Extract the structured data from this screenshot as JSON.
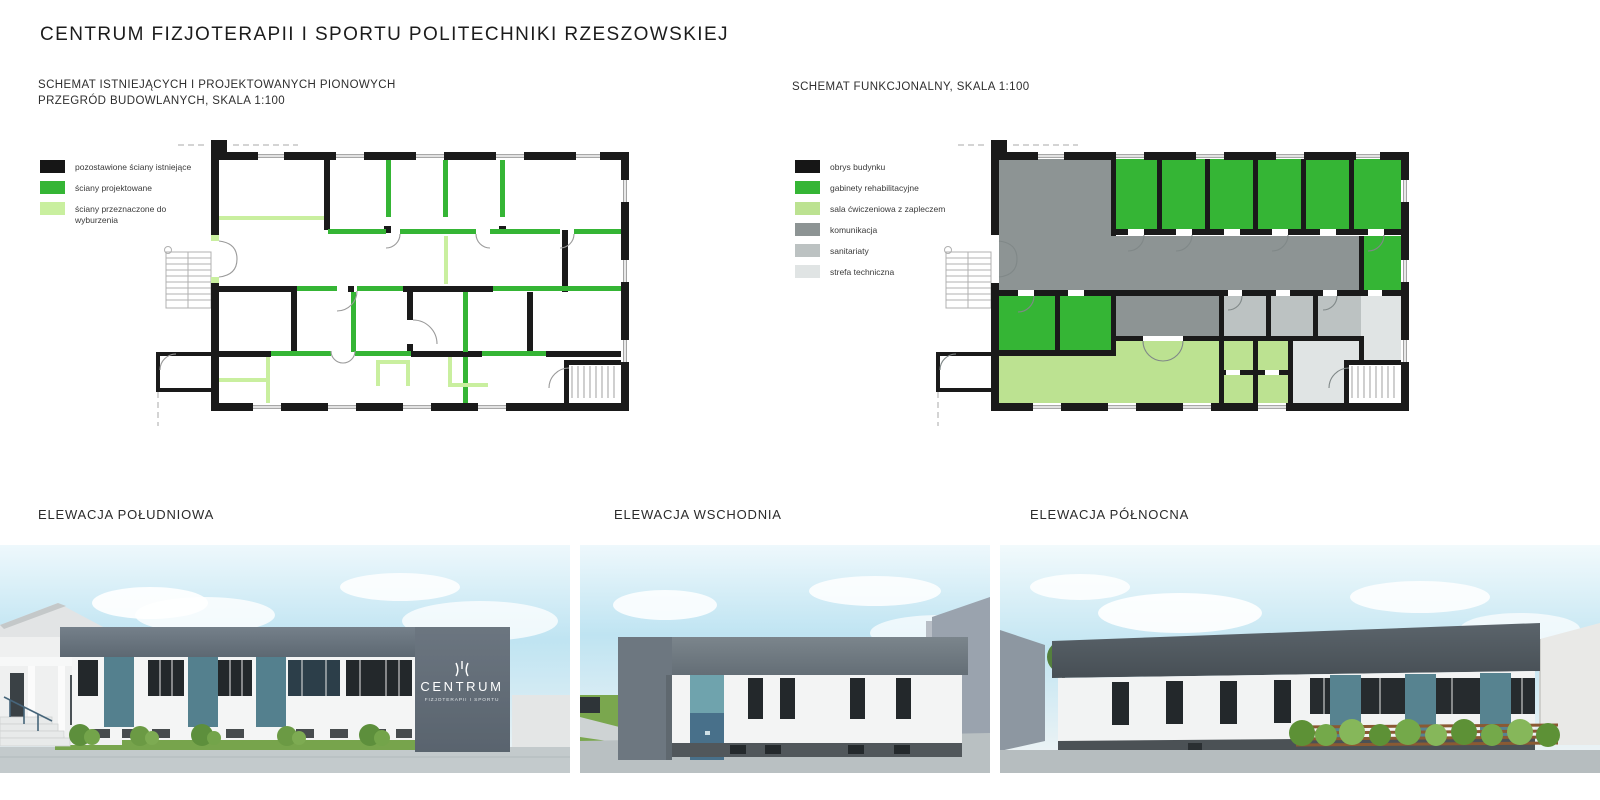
{
  "title": "CENTRUM FIZJOTERAPII I SPORTU POLITECHNIKI RZESZOWSKIEJ",
  "plans": {
    "left": {
      "heading_line1": "SCHEMAT ISTNIEJĄCYCH I PROJEKTOWANYCH PIONOWYCH",
      "heading_line2": "PRZEGRÓD BUDOWLANYCH, SKALA 1:100",
      "legend": [
        {
          "label": "pozostawione ściany istniejące",
          "color": "#161616"
        },
        {
          "label": "ściany projektowane",
          "color": "#35b535"
        },
        {
          "label": "ściany przeznaczone do wyburzenia",
          "color": "#c9ef9f"
        }
      ]
    },
    "right": {
      "heading": "SCHEMAT FUNKCJONALNY, SKALA 1:100",
      "legend": [
        {
          "label": "obrys budynku",
          "color": "#161616"
        },
        {
          "label": "gabinety rehabilitacyjne",
          "color": "#35b535"
        },
        {
          "label": "sala ćwiczeniowa z zapleczem",
          "color": "#bce291"
        },
        {
          "label": "komunikacja",
          "color": "#8d9494"
        },
        {
          "label": "sanitariaty",
          "color": "#bcc2c2"
        },
        {
          "label": "strefa techniczna",
          "color": "#e0e4e4"
        }
      ]
    }
  },
  "elevations": [
    {
      "label": "ELEWACJA POŁUDNIOWA"
    },
    {
      "label": "ELEWACJA WSCHODNIA"
    },
    {
      "label": "ELEWACJA PÓŁNOCNA"
    }
  ],
  "signage": {
    "name": "CENTRUM",
    "subtitle": "FIZJOTERAPII I SPORTU"
  },
  "palette": {
    "wall_black": "#1a1a1a",
    "projected_green": "#35b535",
    "demolition_green": "#c9ef9f",
    "corridor_gray": "#8d9494",
    "sanitary_gray": "#bcc2c2",
    "technical_gray": "#e0e4e4",
    "exercise_green": "#bce291",
    "facade_dark": "#6b7680",
    "teal_panel": "#54808e",
    "door_blue": "#48708a",
    "sky_blue": "#bfe4f2",
    "grass_green": "#77a44c",
    "pavement_gray": "#c3cacc"
  }
}
